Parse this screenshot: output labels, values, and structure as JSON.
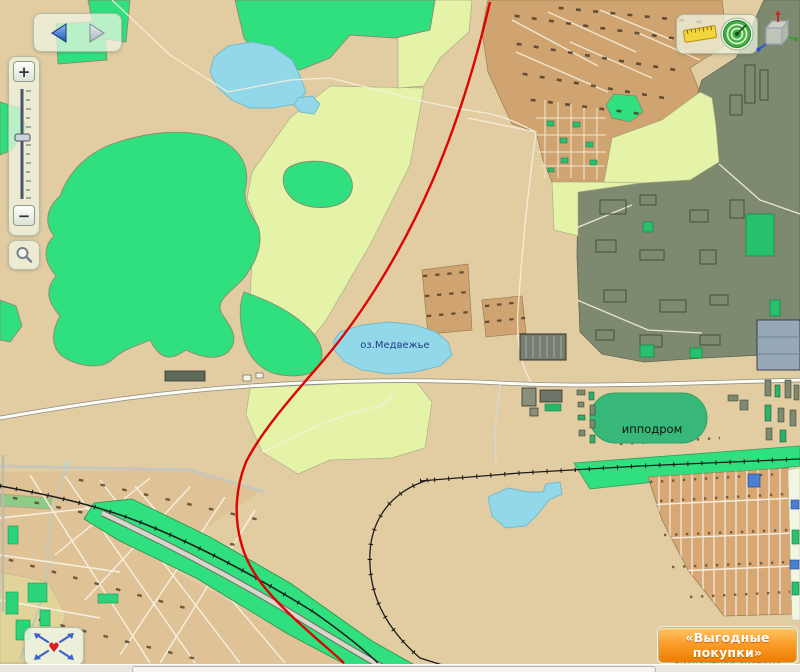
{
  "map": {
    "labels": {
      "lake": "оз.Медвежье",
      "hippodrome": "ипподром"
    }
  },
  "zoom_panel": {
    "zoom_in": "+",
    "zoom_out": "−"
  },
  "icons": {
    "heart": "♥"
  },
  "ad": {
    "title": "«Выгодные покупки»",
    "subtitle": "дисконтная система"
  },
  "colors": {
    "land": "#E2CDA2",
    "forest": "#30DF7E",
    "field": "#E4F3A8",
    "water": "#92D8E8",
    "industrial": "#7D8A6F",
    "road_red": "#DD0404",
    "urban": "#DDB98C",
    "plots": "#D8A874",
    "ad_orange": "#F07D00"
  }
}
